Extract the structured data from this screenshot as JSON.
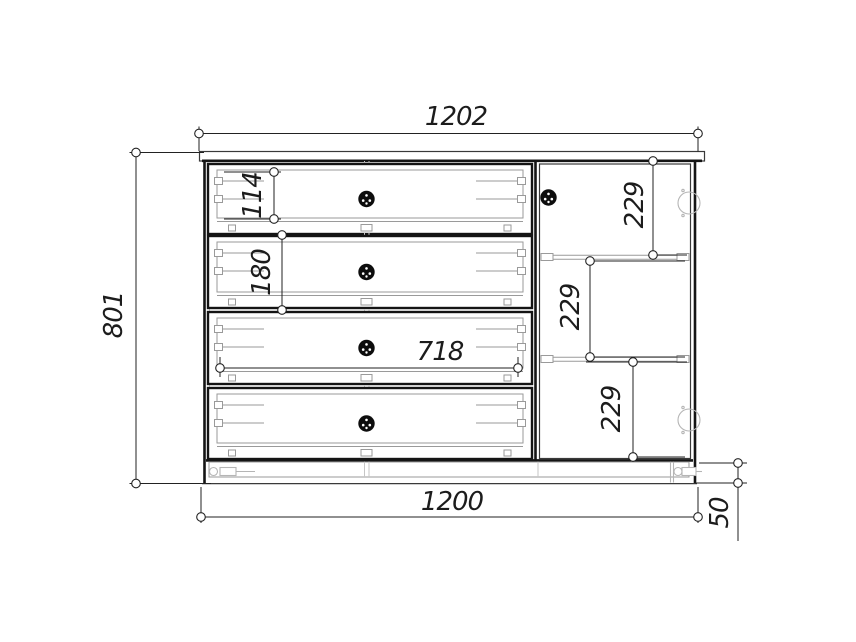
{
  "drawing": {
    "dims": {
      "top_width": "1202",
      "overall_height": "801",
      "drawer1_box_height": "114",
      "drawer2_box_height": "180",
      "inner_width": "718",
      "door_section_top": "229",
      "door_section_middle": "229",
      "door_section_bottom": "229",
      "bottom_width": "1200",
      "plinth_height": "50"
    },
    "colors": {
      "outline": "#141414",
      "dimension": "#222222",
      "hardware": "#b5b5b5",
      "background": "#ffffff"
    }
  }
}
